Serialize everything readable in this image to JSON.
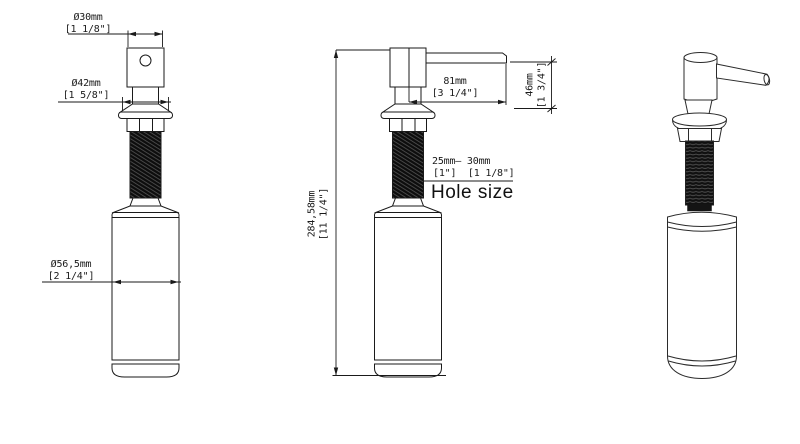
{
  "drawing": {
    "front_view": {
      "head_dia_mm": "Ø30mm",
      "head_dia_in": "[1 1/8\"]",
      "flange_dia_mm": "Ø42mm",
      "flange_dia_in": "[1 5/8\"]",
      "bottle_dia_mm": "Ø56,5mm",
      "bottle_dia_in": "[2 1/4\"]"
    },
    "side_view": {
      "spout_reach_mm": "81mm",
      "spout_reach_in": "[3 1/4\"]",
      "spout_height_mm": "46mm",
      "spout_height_in": "[1 3/4\"]",
      "overall_height_mm": "284,58mm",
      "overall_height_in": "[11 1/4\"]",
      "hole_range_mm": "25mm— 30mm",
      "hole_range_in": "[1\"]  [1 1/8\"]",
      "hole_label": "Hole size"
    },
    "colors": {
      "line": "#1a1a1a",
      "background": "#ffffff",
      "thread_fill": "#0d0d0d"
    }
  }
}
